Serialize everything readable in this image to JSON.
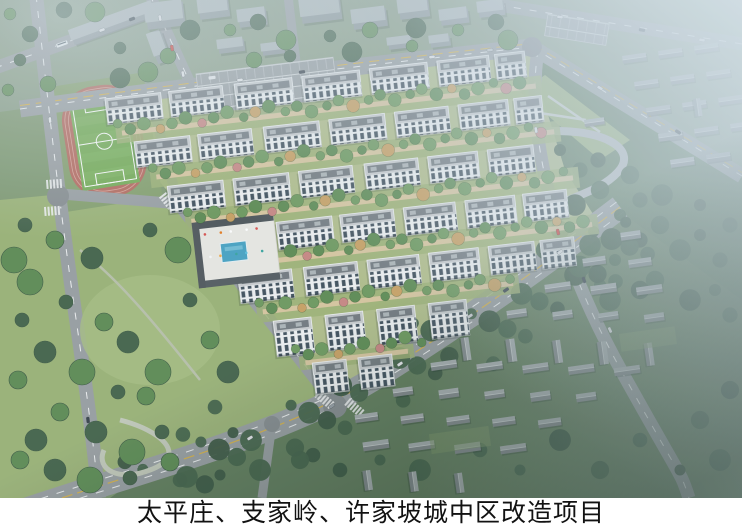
{
  "caption": {
    "title": "太平庄、支家岭、许家坡城中区改造项目"
  },
  "scene": {
    "type": "aerial-architectural-rendering",
    "landmarks": [
      "football-field",
      "running-track",
      "residential-complex",
      "apartment-buildings",
      "swimming-pool",
      "central-plaza",
      "main-boulevard",
      "parking-lot",
      "old-town-houses",
      "city-park",
      "trees",
      "vehicles"
    ]
  },
  "colors": {
    "caption_bg": "#ffffff",
    "caption_text": "#121212",
    "base_green": "#7f9a72",
    "north_urban": "#8ba088",
    "east_wood": "#5e7c5c",
    "village_ground": "#64805f",
    "park_lawn": "#9cb478",
    "complex_ground": "#b2bf8c",
    "road": "#9aa0a3",
    "road_dark": "#888e91",
    "lane_white": "#eef0f1",
    "lane_yellow": "#d7b34c",
    "pitch_green": "#74ac55",
    "pitch_light": "#80b761",
    "track_red": "#b56a5e",
    "track_line": "#d9a398",
    "tree_green": "#5f8d55",
    "tree_green2": "#6f9b60",
    "tree_dark": "#46654c",
    "tree_darker": "#3d5a45",
    "tree_amber": "#c9a264",
    "tree_pink": "#c98884",
    "bldg_face": "#eef1f2",
    "bldg_win": "#42525e",
    "bldg_roof": "#c9cdcf",
    "bldg_roof_dark": "#747c81",
    "box_wall": "#8f999c",
    "box_top": "#b0b9bb",
    "village_roof_light": "#aab1b3",
    "village_roof_dark": "#848b8e",
    "pool_blue": "#4aa4c4",
    "plaza": "#e9e9e4",
    "path_beige": "#d8c7a0",
    "haze": "#cddbe4"
  }
}
